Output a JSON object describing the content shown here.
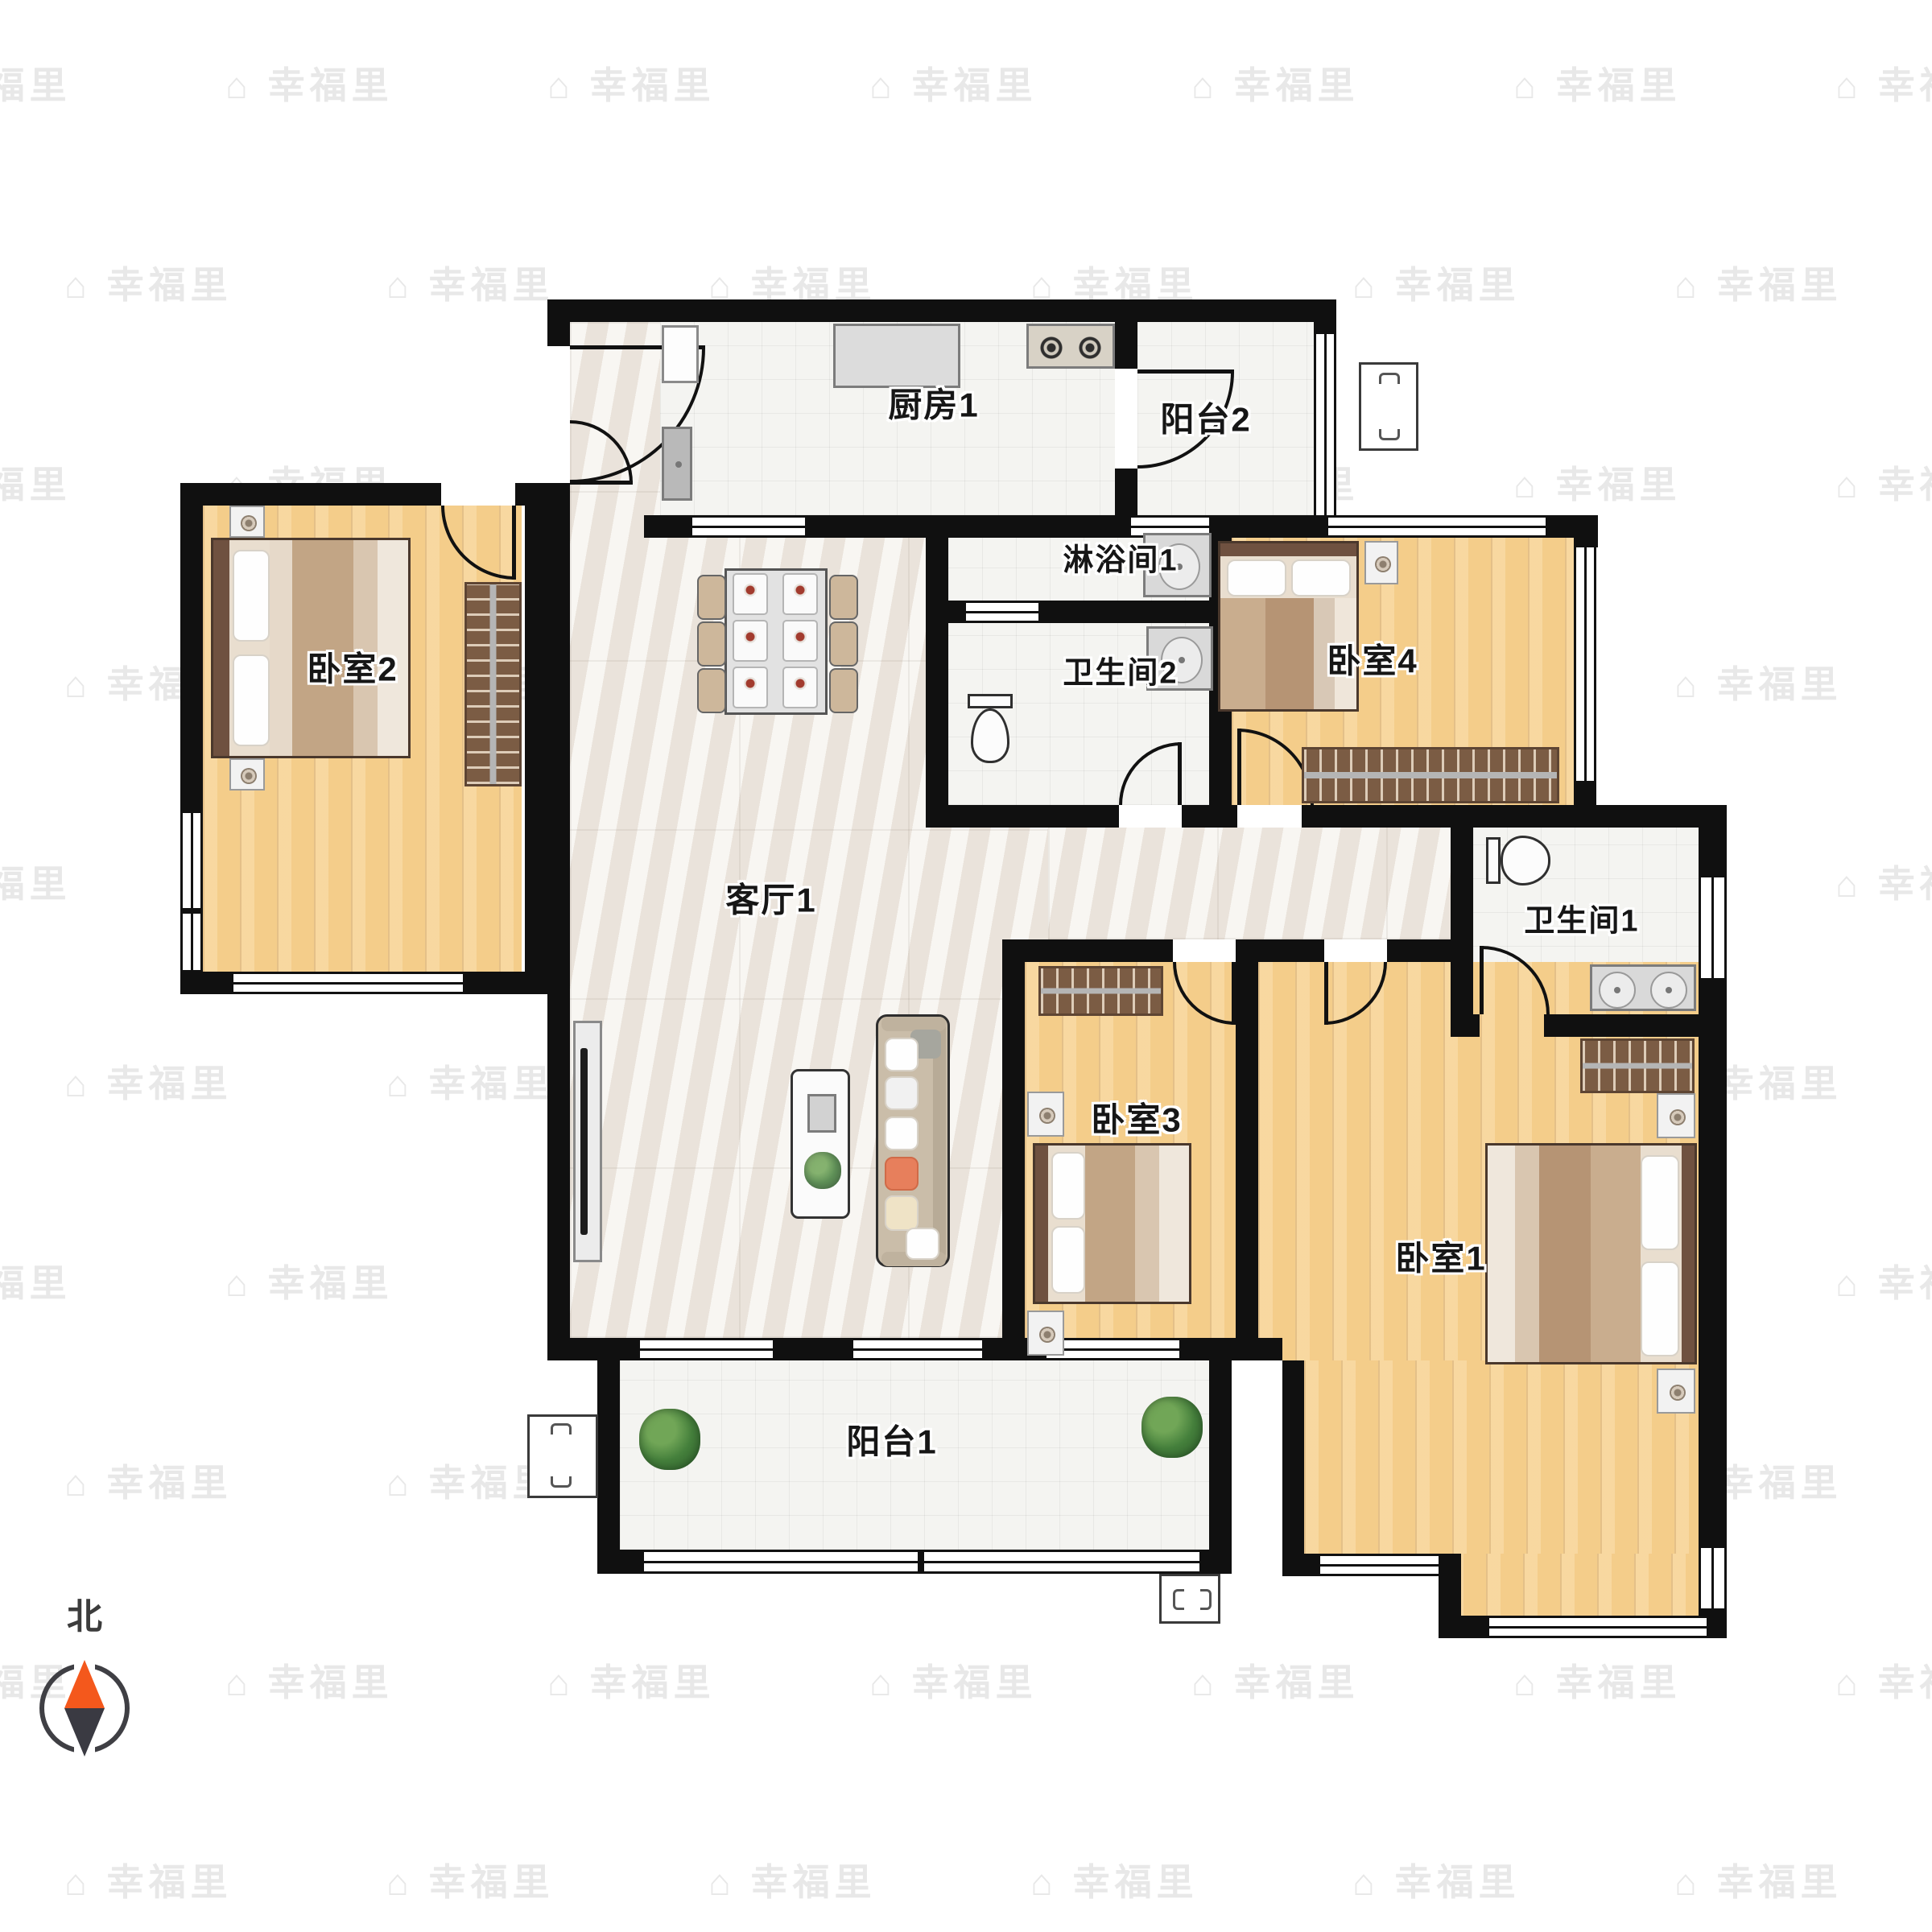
{
  "rooms": [
    {
      "id": "kitchen",
      "label": "厨房1"
    },
    {
      "id": "balcony2",
      "label": "阳台2"
    },
    {
      "id": "shower1",
      "label": "淋浴间1"
    },
    {
      "id": "bathroom2",
      "label": "卫生间2"
    },
    {
      "id": "bedroom4",
      "label": "卧室4"
    },
    {
      "id": "bedroom2",
      "label": "卧室2"
    },
    {
      "id": "living",
      "label": "客厅1"
    },
    {
      "id": "bathroom1",
      "label": "卫生间1"
    },
    {
      "id": "bedroom3",
      "label": "卧室3"
    },
    {
      "id": "bedroom1",
      "label": "卧室1"
    },
    {
      "id": "balcony1",
      "label": "阳台1"
    }
  ],
  "compass": {
    "label": "北",
    "needle_up_color": "#f4581c",
    "needle_down_color": "#3a3a42"
  },
  "watermark": {
    "icon": "⌂",
    "text": "幸福里"
  },
  "colors": {
    "wall": "#101010",
    "wood_floor": "#f4cd8a",
    "marble_floor": "#f0eae3",
    "tile_floor": "#f4f4f1",
    "wardrobe": "#7b5c44"
  }
}
